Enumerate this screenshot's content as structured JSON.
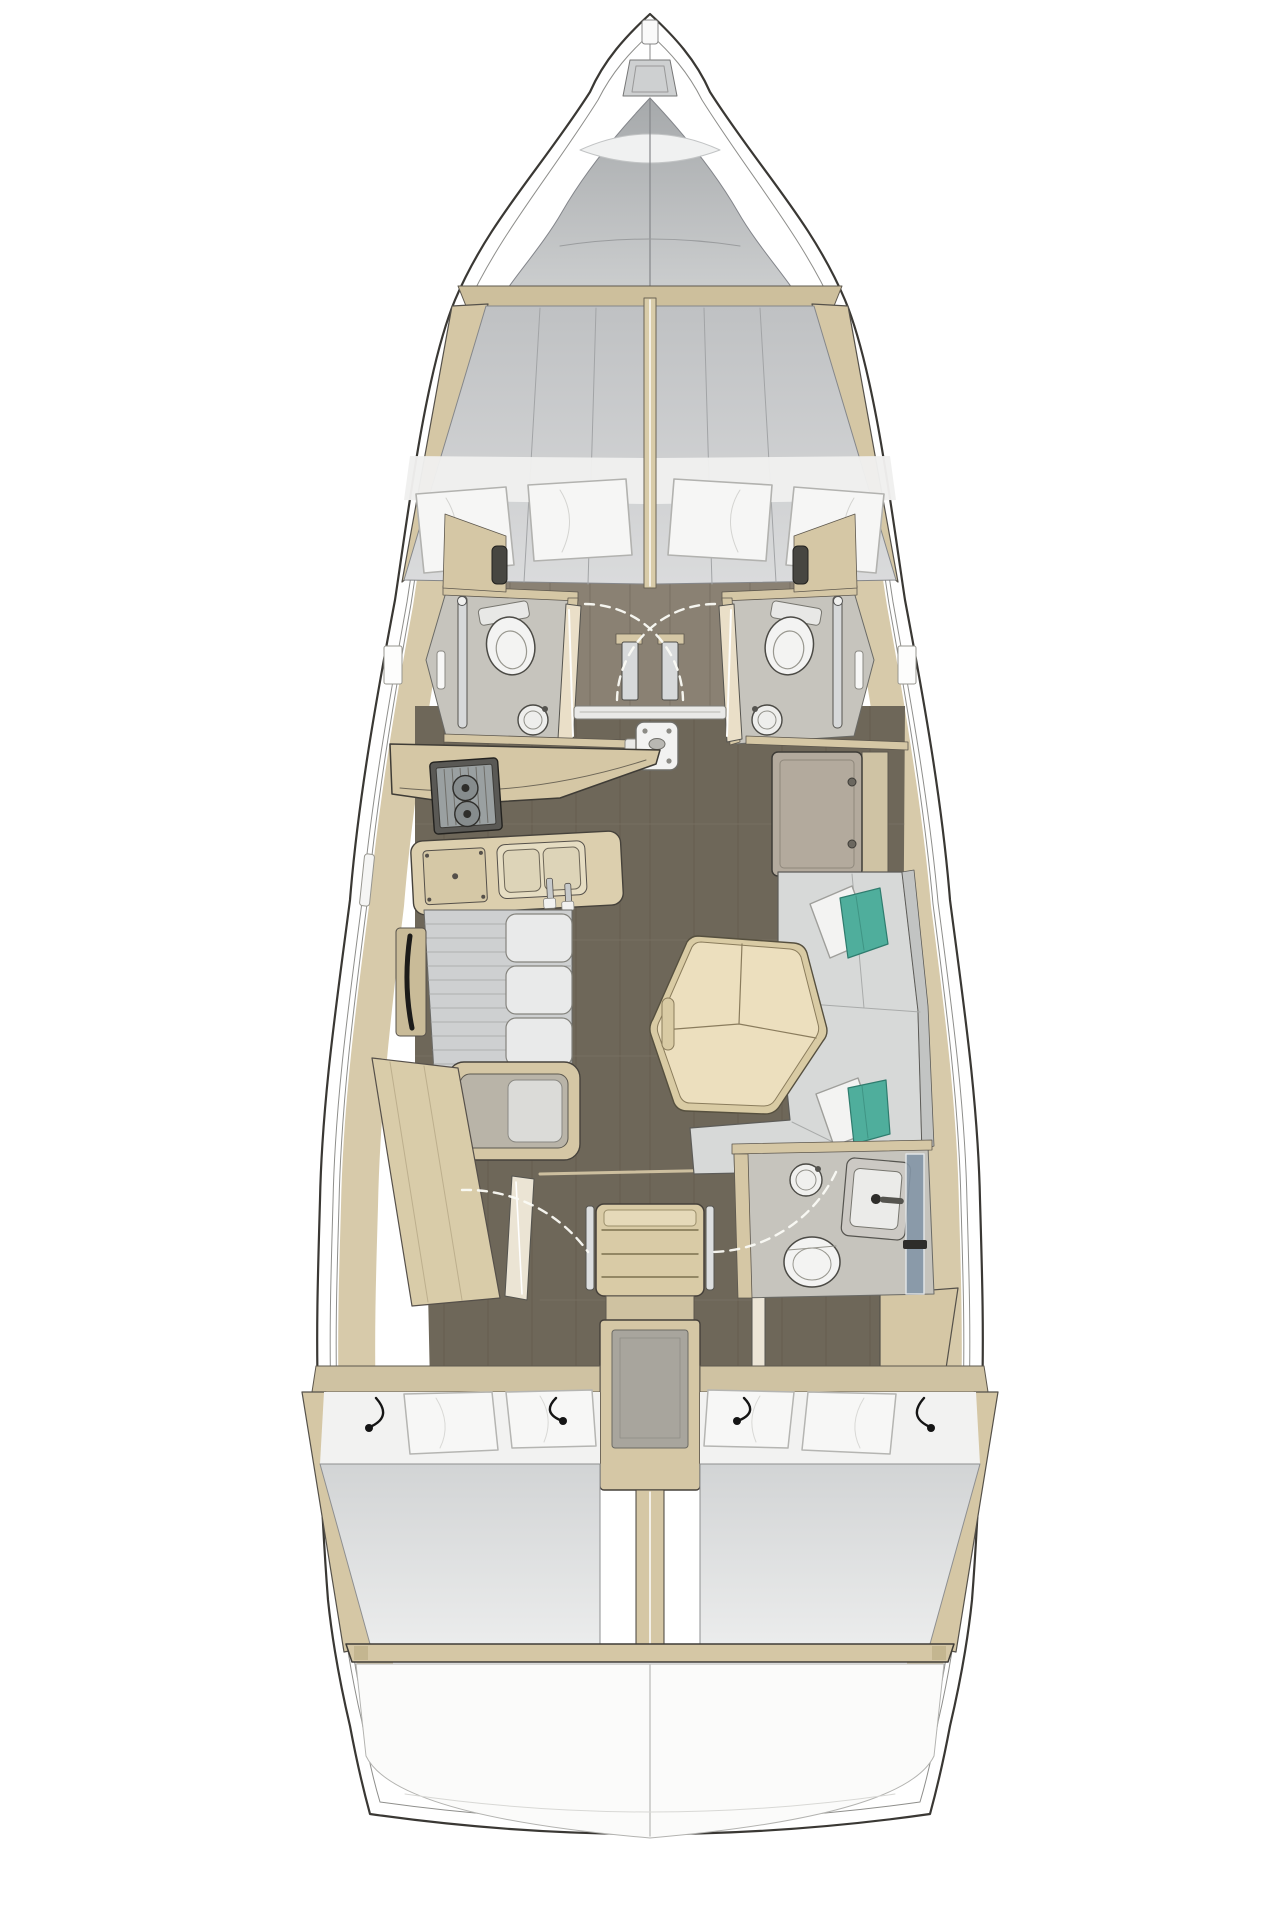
{
  "title": "Sailing yacht interior layout — top-view floor plan (bow up)",
  "diagram_type": "yacht-floor-plan",
  "orientation": "bow-up",
  "colors": {
    "bg": "#ffffff",
    "line": "#3a3834",
    "deck": "#b2b5b7",
    "wood": "#d5c7a5",
    "wood_dark": "#c9bb98",
    "wood_light": "#eadfc8",
    "table": "#ecdfbe",
    "floor": "#6e6759",
    "floor_mid": "#8a8173",
    "plank": "#5f584a",
    "bath": "#c6c4bd",
    "mattress": "#c9cbcd",
    "linen": "#f2f2f1",
    "cushion": "#d7d9d8",
    "teal": "#4fae9c",
    "taupe": "#b3aa9d",
    "chrome": "#d7d9da",
    "glass": "#8496a7",
    "dark": "#3a3834"
  },
  "areas": {
    "bow": {
      "features": [
        "anchor-locker",
        "bow-fitting",
        "deck-hatch"
      ]
    },
    "forward_cabin": {
      "type": "V-berth double cabin",
      "berths": 2,
      "pillows": 4
    },
    "forward_heads": [
      {
        "side": "port",
        "fixtures": [
          "toilet",
          "shower-column",
          "round-sink",
          "wardrobe",
          "door"
        ]
      },
      {
        "side": "starboard",
        "fixtures": [
          "toilet",
          "shower-column",
          "round-sink",
          "wardrobe",
          "door"
        ]
      }
    ],
    "mast_step": {
      "location": "saloon sole, centerline"
    },
    "galley": {
      "side": "port",
      "equipment": [
        "two-burner-stove",
        "double-sink",
        "fridge",
        "counter"
      ]
    },
    "saloon": {
      "port": [
        "settee",
        "back-cushions",
        "grab-rail",
        "bench-seat"
      ],
      "starboard": [
        "storage-cabinet",
        "c-shaped-sofa",
        "hexagonal-folding-table"
      ],
      "accent_pillow_pairs": 2
    },
    "companionway": {
      "steps": 3,
      "location": "centerline",
      "below": "engine-box"
    },
    "aft_cabins": [
      {
        "side": "port",
        "bed": "double",
        "pillows": 2,
        "features": [
          "wardrobe",
          "door",
          "reading-lights"
        ]
      },
      {
        "side": "starboard",
        "bed": "double",
        "pillows": 2,
        "features": [
          "door",
          "reading-lights"
        ]
      }
    ],
    "aft_head": {
      "side": "starboard",
      "fixtures": [
        "toilet",
        "round-sink",
        "vanity-basin",
        "shower-glass",
        "door"
      ]
    },
    "stern": {
      "features": [
        "transom-locker",
        "aft-deck"
      ]
    }
  }
}
